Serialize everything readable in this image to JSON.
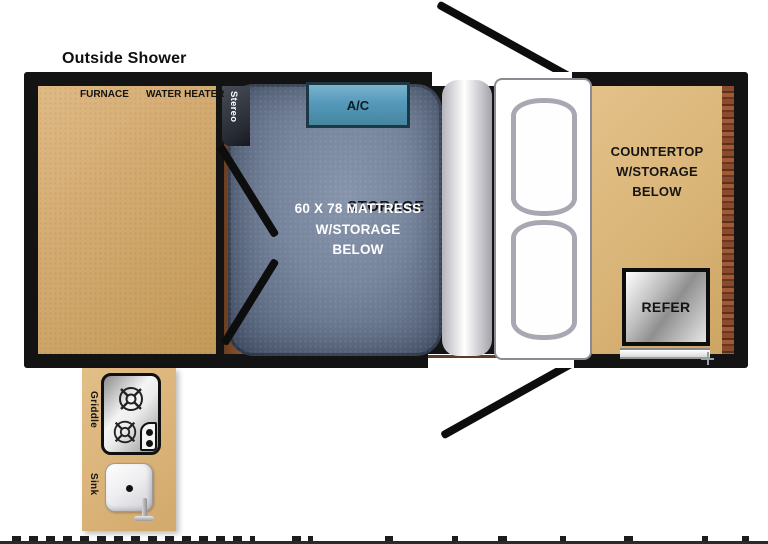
{
  "page": {
    "outside_shower_label": "Outside Shower"
  },
  "plan": {
    "storage": {
      "furnace_label": "FURNACE",
      "water_heater_label": "WATER HEATER",
      "label": "STORAGE"
    },
    "stereo_label": "Stereo",
    "ac_label": "A/C",
    "mattress": {
      "lines": [
        "60 X 78 MATTRESS",
        "W/STORAGE",
        "BELOW"
      ]
    },
    "countertop": {
      "lines": [
        "COUNTERTOP",
        "W/STORAGE",
        "BELOW"
      ]
    },
    "refer_label": "REFER"
  },
  "kitchen": {
    "griddle_label": "Griddle",
    "sink_label": "Sink"
  },
  "icons": {
    "burner": "gas-burner-icon",
    "drain": "sink-drain-icon",
    "faucet": "faucet-icon",
    "crosshair": "crosshair-mark",
    "door_swing": "door-swing-line"
  },
  "colors": {
    "wall_black": "#131313",
    "storage_tan": "#d4ab72",
    "countertop_tan": "#d9b477",
    "kitchen_tan": "#dcba81",
    "mattress_blue": "#6d7c95",
    "ac_teal": "#5499bb",
    "canvas_brown": "#7b4a2a",
    "wood_grain_brown": "#8a4a2e",
    "bed_white": "#ffffff",
    "pillow_gray": "#a8a8b2"
  }
}
